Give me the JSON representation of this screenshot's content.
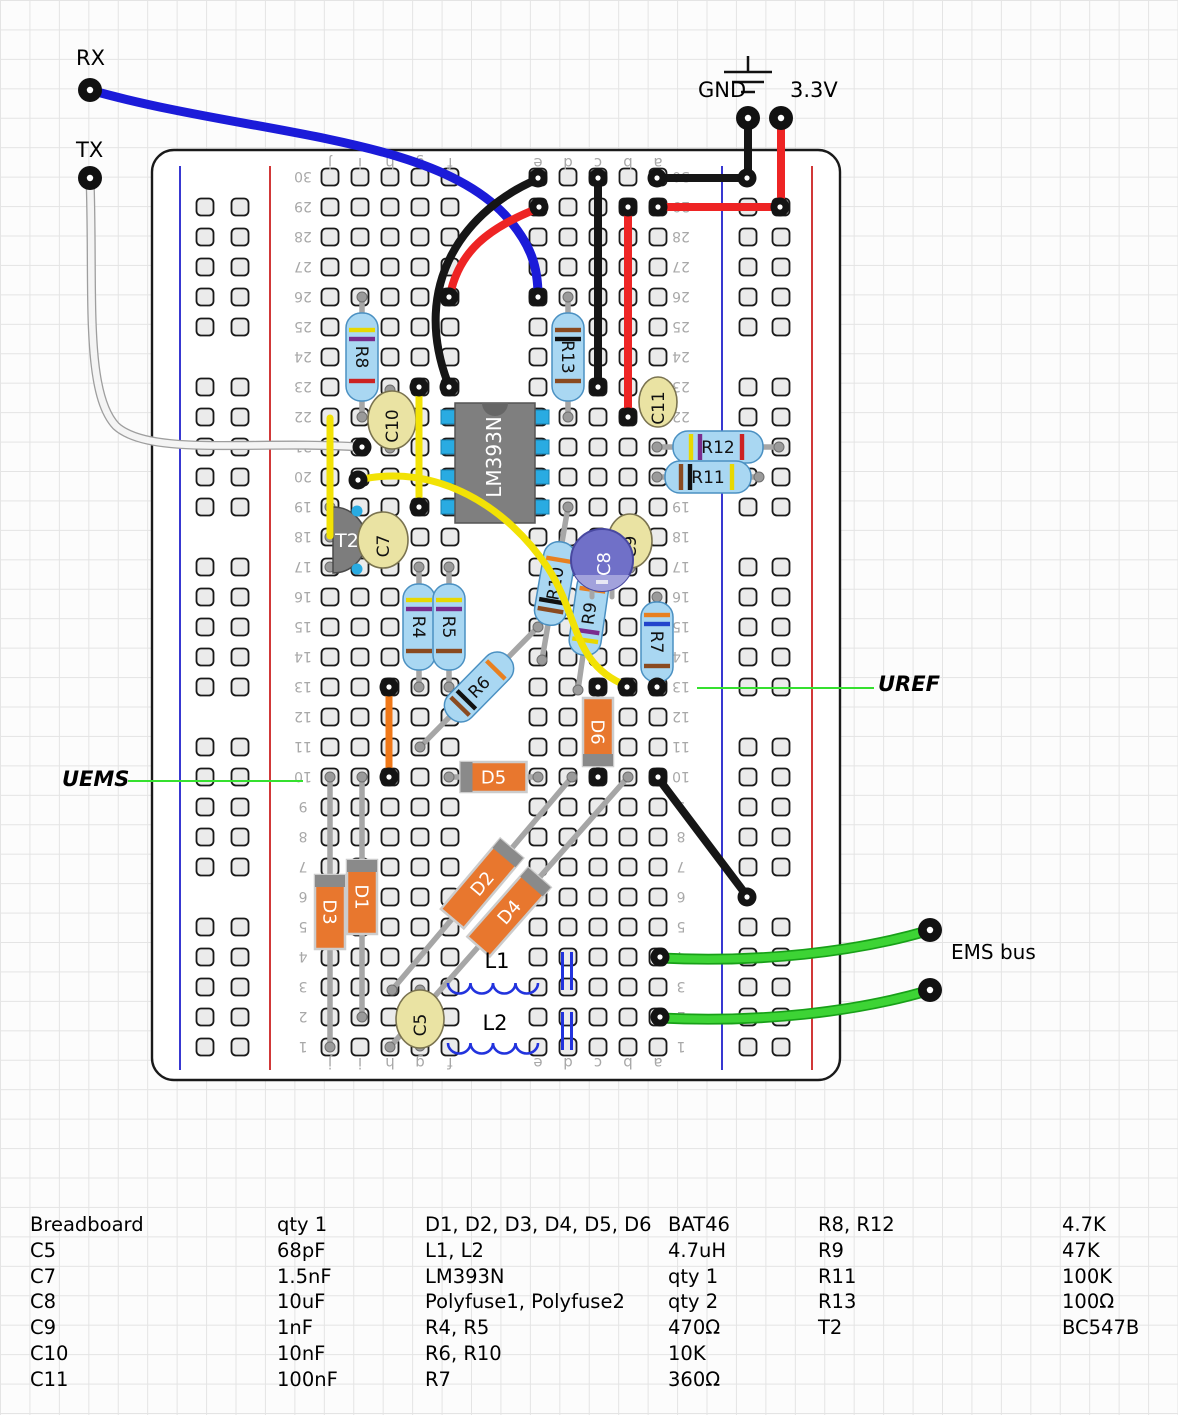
{
  "annotations": {
    "rx": "RX",
    "tx": "TX",
    "gnd": "GND",
    "v33": "3.3V",
    "uref": "UREF",
    "uems": "UEMS",
    "ems_bus": "EMS bus"
  },
  "colors": {
    "wire_blue": "#1b1bd9",
    "wire_red": "#ee2424",
    "wire_black": "#161616",
    "wire_yellow": "#f2e205",
    "wire_orange": "#f07818",
    "wire_green": "#3dd435",
    "wire_green_casing": "#18a018",
    "wire_white": "#f4f4f4",
    "wire_white_casing": "#9e9e9e",
    "annotation_green": "#35e02f",
    "resistor_body": "#a9d7f2",
    "resistor_edge": "#4a90c2",
    "diode_body": "#e8772e",
    "diode_edge": "#cccccc",
    "diode_band": "#8a8a8a",
    "cap_tan": "#eae3a3",
    "cap_tan_edge": "#7a7350",
    "cap_electro": "#7070c8",
    "cap_electro_lower": "#a2a2dc",
    "ic_gray": "#7f7f7f",
    "ic_notch": "#666666",
    "pin_blue": "#29abe2",
    "transistor_gray": "#7d7d7d",
    "lead_gray": "#a6a6a6",
    "hole_fill": "#ebebeb",
    "hole_edge": "#1a1a1a",
    "rail_blue": "#2222cc",
    "rail_red": "#cc2222",
    "board_edge": "#1a1a1a",
    "index_text": "#a8a8a8"
  },
  "breadboard": {
    "x": 152,
    "y": 150,
    "w": 688,
    "h": 930,
    "corner": 22,
    "rows": 30,
    "columns": [
      "j",
      "i",
      "h",
      "g",
      "f",
      "e",
      "d",
      "c",
      "b",
      "a"
    ],
    "col_x": [
      330,
      360,
      390,
      420,
      450,
      538,
      568,
      598,
      628,
      658
    ],
    "row_y0": 1047,
    "row_dy": 30,
    "rails": [
      {
        "x": 180,
        "color": "#2222cc"
      },
      {
        "x": 270,
        "color": "#cc2222"
      },
      {
        "x": 722,
        "color": "#2222cc"
      },
      {
        "x": 812,
        "color": "#cc2222"
      }
    ],
    "rail_hole_x": [
      205,
      240,
      748,
      781
    ],
    "num_x": [
      303,
      681
    ],
    "letter_y": [
      163,
      1063
    ]
  },
  "gnd_symbol": {
    "x": 748,
    "stem_top": 56,
    "stem_bottom": 72,
    "lines": [
      [
        724,
        72,
        772
      ],
      [
        732,
        82,
        764
      ],
      [
        741,
        92,
        755
      ]
    ]
  },
  "terminals": [
    {
      "name": "rx",
      "x": 90,
      "y": 90
    },
    {
      "name": "tx",
      "x": 90,
      "y": 178
    },
    {
      "name": "gnd",
      "x": 748,
      "y": 118
    },
    {
      "name": "v33",
      "x": 781,
      "y": 118
    },
    {
      "name": "ems-top",
      "x": 930,
      "y": 930
    },
    {
      "name": "ems-bottom",
      "x": 930,
      "y": 990
    }
  ],
  "annotation_lines": [
    {
      "name": "uref-line",
      "x1": 697,
      "y1": 688,
      "x2": 874,
      "y2": 688
    },
    {
      "name": "uems-line",
      "x1": 128,
      "y1": 781,
      "x2": 303,
      "y2": 781
    }
  ],
  "components": [
    {
      "id": "R8",
      "type": "resistor",
      "label": "R8",
      "x1": 362,
      "y1": 297,
      "x2": 362,
      "y2": 417,
      "body": 88,
      "bands": [
        "#e8d800",
        "#7a2c8e",
        "#cc2222"
      ]
    },
    {
      "id": "R13",
      "type": "resistor",
      "label": "R13",
      "x1": 568,
      "y1": 297,
      "x2": 568,
      "y2": 417,
      "body": 88,
      "bands": [
        "#8a4a20",
        "#111111",
        "#8a4a20"
      ]
    },
    {
      "id": "R12",
      "type": "resistor",
      "label": "R12",
      "x1": 657,
      "y1": 447,
      "x2": 779,
      "y2": 447,
      "body": 90,
      "bands": [
        "#e8d800",
        "#7a2c8e",
        "#cc2222"
      ]
    },
    {
      "id": "R11",
      "type": "resistor",
      "label": "R11",
      "x1": 657,
      "y1": 477,
      "x2": 759,
      "y2": 477,
      "body": 86,
      "bands": [
        "#8a4a20",
        "#111111",
        "#e8d800"
      ]
    },
    {
      "id": "R4",
      "type": "resistor",
      "label": "R4",
      "x1": 419,
      "y1": 567,
      "x2": 419,
      "y2": 687,
      "body": 86,
      "bands": [
        "#e8d800",
        "#7a2c8e",
        "#8a4a20"
      ]
    },
    {
      "id": "R5",
      "type": "resistor",
      "label": "R5",
      "x1": 449,
      "y1": 567,
      "x2": 449,
      "y2": 687,
      "body": 86,
      "bands": [
        "#e8d800",
        "#7a2c8e",
        "#8a4a20"
      ]
    },
    {
      "id": "R7",
      "type": "resistor",
      "label": "R7",
      "x1": 657,
      "y1": 597,
      "x2": 657,
      "y2": 687,
      "body": 80,
      "bands": [
        "#e88020",
        "#2244cc",
        "#8a4a20"
      ]
    },
    {
      "id": "R6",
      "type": "resistor",
      "label": "R6",
      "x1": 420,
      "y1": 747,
      "x2": 538,
      "y2": 627,
      "body": 84,
      "bands": [
        "#8a4a20",
        "#111111",
        "#e88020"
      ]
    },
    {
      "id": "R10",
      "type": "resistor",
      "label": "R10",
      "x1": 568,
      "y1": 507,
      "x2": 542,
      "y2": 660,
      "body": 84,
      "bands": [
        "#8a4a20",
        "#111111",
        "#e88020"
      ]
    },
    {
      "id": "R9",
      "type": "resistor",
      "label": "R9",
      "x1": 600,
      "y1": 537,
      "x2": 578,
      "y2": 690,
      "body": 84,
      "bands": [
        "#e8d800",
        "#7a2c8e",
        "#e88020"
      ]
    },
    {
      "id": "D5",
      "type": "diode",
      "label": "D5",
      "x1": 449,
      "y1": 777,
      "x2": 538,
      "y2": 777,
      "body": 66,
      "band_end": 1
    },
    {
      "id": "D6",
      "type": "diode",
      "label": "D6",
      "x1": 598,
      "y1": 687,
      "x2": 598,
      "y2": 777,
      "body": 68,
      "band_end": 2
    },
    {
      "id": "D1",
      "type": "diode",
      "label": "D1",
      "x1": 362,
      "y1": 777,
      "x2": 362,
      "y2": 1017,
      "body": 74,
      "band_end": 1
    },
    {
      "id": "D3",
      "type": "diode",
      "label": "D3",
      "x1": 330,
      "y1": 777,
      "x2": 330,
      "y2": 1047,
      "body": 74,
      "band_end": 1
    },
    {
      "id": "D2",
      "type": "diode",
      "label": "D2",
      "x1": 572,
      "y1": 777,
      "x2": 392,
      "y2": 990,
      "body": 92,
      "band_end": 2
    },
    {
      "id": "D4",
      "type": "diode",
      "label": "D4",
      "x1": 628,
      "y1": 777,
      "x2": 390,
      "y2": 1047,
      "body": 92,
      "band_end": 2
    },
    {
      "id": "L1",
      "type": "inductor",
      "label": "L1",
      "x1": 448,
      "y1": 983,
      "x2": 538,
      "y2": 983,
      "label_x": 497,
      "label_y": 968
    },
    {
      "id": "L2",
      "type": "inductor",
      "label": "L2",
      "x1": 448,
      "y1": 1043,
      "x2": 538,
      "y2": 1043,
      "label_x": 495,
      "label_y": 1030
    },
    {
      "id": "PF1",
      "type": "polyfuse",
      "label": "",
      "x": 567,
      "y1": 952,
      "y2": 990
    },
    {
      "id": "PF2",
      "type": "polyfuse",
      "label": "",
      "x": 567,
      "y1": 1012,
      "y2": 1050
    },
    {
      "id": "T2",
      "type": "transistor",
      "label": "T2",
      "cx": 333,
      "cy": 540,
      "r": 33
    },
    {
      "id": "IC1",
      "type": "ic",
      "label": "LM393N",
      "x": 455,
      "y": 403,
      "w": 80,
      "h": 120,
      "pins_y": [
        417,
        447,
        477,
        507
      ]
    },
    {
      "id": "C10",
      "type": "cap",
      "label": "C10",
      "cx": 392,
      "cy": 420,
      "rx": 24,
      "ry": 29,
      "lx": 390,
      "ly1": 390,
      "ly2": 448
    },
    {
      "id": "C7",
      "type": "cap",
      "label": "C7",
      "cx": 383,
      "cy": 540,
      "rx": 25,
      "ry": 28,
      "lx": 383,
      "ly1": 518,
      "ly2": 562
    },
    {
      "id": "C11",
      "type": "cap",
      "label": "C11",
      "cx": 658,
      "cy": 402,
      "rx": 19,
      "ry": 25,
      "lx": 658,
      "ly1": 387,
      "ly2": 417
    },
    {
      "id": "C9",
      "type": "cap",
      "label": "C9",
      "cx": 630,
      "cy": 541,
      "rx": 22,
      "ry": 27,
      "lx": 630,
      "ly1": 520,
      "ly2": 568
    },
    {
      "id": "C5",
      "type": "cap",
      "label": "C5",
      "cx": 420,
      "cy": 1019,
      "rx": 24,
      "ry": 29,
      "lx": 420,
      "ly1": 990,
      "ly2": 1046
    },
    {
      "id": "C8",
      "type": "cap_electro",
      "label": "C8",
      "cx": 602,
      "cy": 560,
      "r": 31
    }
  ],
  "wires": [
    {
      "name": "wire-rx-blue",
      "color": "blue",
      "w": 9,
      "path": "M 90 90 C 250 135 430 135 505 215 C 532 245 538 268 538 296"
    },
    {
      "name": "wire-tx-white",
      "color": "white",
      "w": 6.5,
      "path": "M 90 178 C 94 290 84 392 116 426 C 150 457 255 440 360 447"
    },
    {
      "name": "wire-gnd-drop",
      "color": "black",
      "w": 8,
      "path": "M 748 118 L 748 179"
    },
    {
      "name": "wire-v33-drop",
      "color": "red",
      "w": 8,
      "path": "M 781 118 L 781 207"
    },
    {
      "name": "wire-row30-gnd",
      "color": "black",
      "w": 8,
      "path": "M 657 178 L 747 178"
    },
    {
      "name": "wire-row29-v33",
      "color": "red",
      "w": 8,
      "path": "M 658 207 L 780 207"
    },
    {
      "name": "wire-col-c",
      "color": "black",
      "w": 8,
      "path": "M 598 179 L 598 386"
    },
    {
      "name": "wire-col-b",
      "color": "red",
      "w": 8,
      "path": "M 628 208 L 628 416"
    },
    {
      "name": "wire-black-curve",
      "color": "black",
      "w": 8,
      "path": "M 538 179 C 468 208 408 282 449 386"
    },
    {
      "name": "wire-red-curve",
      "color": "red",
      "w": 8,
      "path": "M 539 208 C 487 228 459 252 450 295"
    },
    {
      "name": "wire-yellow-1",
      "color": "yellow",
      "w": 7,
      "path": "M 419 388 L 419 506"
    },
    {
      "name": "wire-yellow-2",
      "color": "yellow",
      "w": 7,
      "path": "M 330 418 L 330 536"
    },
    {
      "name": "wire-yellow-3",
      "color": "yellow",
      "w": 7,
      "path": "M 358 480 C 438 462 508 508 548 568 C 580 618 572 664 627 686"
    },
    {
      "name": "wire-orange",
      "color": "orange",
      "w": 7,
      "path": "M 389 688 L 389 776"
    },
    {
      "name": "wire-black-diag",
      "color": "black",
      "w": 8,
      "path": "M 658 778 L 747 896"
    },
    {
      "name": "wire-green-1",
      "color": "green",
      "w": 7.5,
      "path": "M 660 958 C 760 963 855 952 927 931"
    },
    {
      "name": "wire-green-2",
      "color": "green",
      "w": 7.5,
      "path": "M 660 1018 C 760 1023 855 1012 927 991"
    }
  ],
  "junctions": [
    [
      538,
      178
    ],
    [
      598,
      178
    ],
    [
      657,
      178
    ],
    [
      747,
      178
    ],
    [
      658,
      207
    ],
    [
      628,
      207
    ],
    [
      539,
      207
    ],
    [
      780,
      207
    ],
    [
      598,
      387
    ],
    [
      628,
      417
    ],
    [
      449,
      387
    ],
    [
      419,
      387
    ],
    [
      449,
      297
    ],
    [
      538,
      297
    ],
    [
      362,
      447
    ],
    [
      419,
      507
    ],
    [
      358,
      480
    ],
    [
      627,
      687
    ],
    [
      389,
      687
    ],
    [
      389,
      777
    ],
    [
      598,
      687
    ],
    [
      657,
      687
    ],
    [
      598,
      777
    ],
    [
      658,
      777
    ],
    [
      747,
      897
    ],
    [
      660,
      957
    ],
    [
      660,
      1017
    ]
  ],
  "parts_list": {
    "groups": [
      {
        "x_name": 30,
        "x_value": 277,
        "rows": [
          [
            "Breadboard",
            "qty 1"
          ],
          [
            "C5",
            "68pF"
          ],
          [
            "C7",
            "1.5nF"
          ],
          [
            "C8",
            "10uF"
          ],
          [
            "C9",
            "1nF"
          ],
          [
            "C10",
            "10nF"
          ],
          [
            "C11",
            "100nF"
          ]
        ]
      },
      {
        "x_name": 425,
        "x_value": 668,
        "rows": [
          [
            "D1, D2, D3, D4, D5, D6",
            "BAT46"
          ],
          [
            "L1, L2",
            "4.7uH"
          ],
          [
            "LM393N",
            "qty 1"
          ],
          [
            "Polyfuse1, Polyfuse2",
            "qty 2"
          ],
          [
            "R4, R5",
            "470Ω"
          ],
          [
            "R6, R10",
            "10K"
          ],
          [
            "R7",
            "360Ω"
          ]
        ]
      },
      {
        "x_name": 818,
        "x_value": 1062,
        "rows": [
          [
            "R8, R12",
            "4.7K"
          ],
          [
            "R9",
            "47K"
          ],
          [
            "R11",
            "100K"
          ],
          [
            "R13",
            "100Ω"
          ],
          [
            "T2",
            "BC547B"
          ]
        ]
      }
    ]
  }
}
